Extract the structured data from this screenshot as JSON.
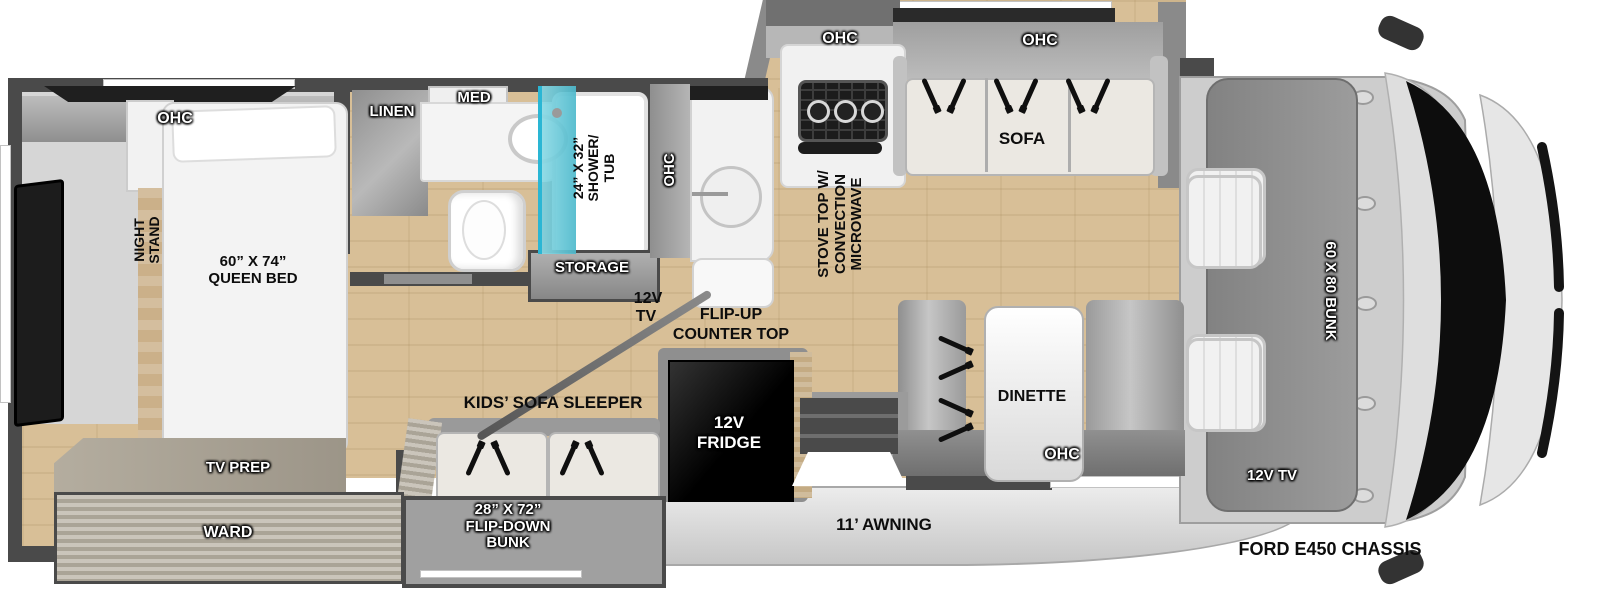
{
  "diagram": {
    "kind": "rv-floorplan-top-view",
    "chassis": "FORD E450 CHASSIS",
    "awning": "11’ AWNING"
  },
  "labels": {
    "bedroom_ohc": "OHC",
    "night_stand_l1": "NIGHT",
    "night_stand_l2": "STAND",
    "queen_bed_l1": "60” X 74”",
    "queen_bed_l2": "QUEEN BED",
    "tv_prep": "TV PREP",
    "ward": "WARD",
    "linen": "LINEN",
    "med": "MED",
    "shower_l1": "24” X 32”",
    "shower_l2": "SHOWER/",
    "shower_l3": "TUB",
    "storage": "STORAGE",
    "hall_tv_l1": "12V",
    "hall_tv_l2": "TV",
    "flip_up_l1": "FLIP-UP",
    "flip_up_l2": "COUNTER TOP",
    "kitchen_ohc": "OHC",
    "stove_ohc": "OHC",
    "stove_l1": "STOVE TOP W/",
    "stove_l2": "CONVECTION",
    "stove_l3": "MICROWAVE",
    "sofa_ohc": "OHC",
    "sofa": "SOFA",
    "dinette": "DINETTE",
    "dinette_ohc": "OHC",
    "fridge_l1": "12V",
    "fridge_l2": "FRIDGE",
    "kids_sofa": "KIDS’ SOFA SLEEPER",
    "flip_down_l1": "28” X 72”",
    "flip_down_l2": "FLIP-DOWN",
    "flip_down_l3": "BUNK",
    "awning": "11’ AWNING",
    "cab_bunk": "60 X 80 BUNK",
    "cab_tv": "12V TV",
    "chassis": "FORD E450 CHASSIS"
  },
  "colors": {
    "wall": "#4a4a4a",
    "wood_floor": "#d8bf97",
    "carpet": "#d6d6d6",
    "shower_glass": "#55c4d6",
    "fridge": "#0c0c0c",
    "cab_body": "#d6d6d6",
    "windshield": "#0d0d0d",
    "label_dark": "#0d0d0d",
    "label_light": "#ffffff"
  }
}
